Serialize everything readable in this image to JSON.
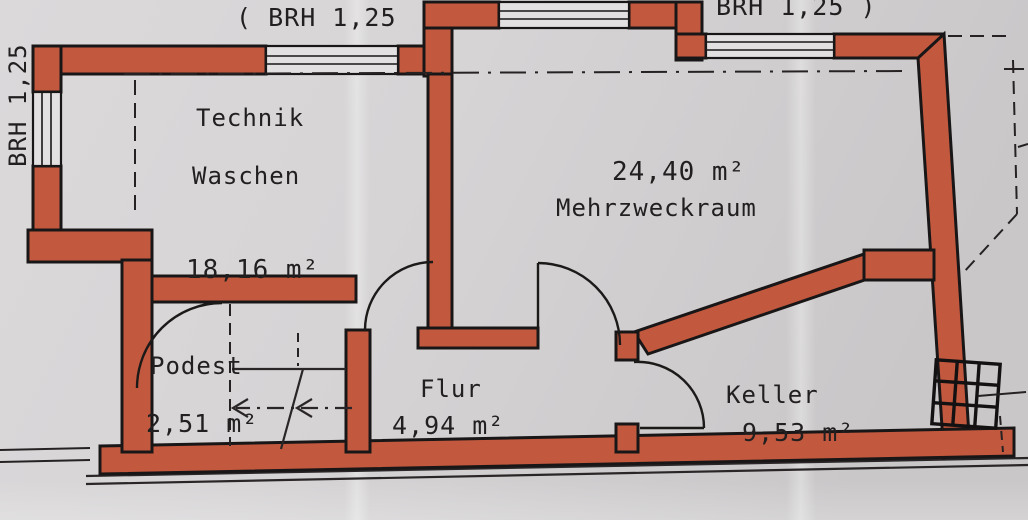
{
  "colors": {
    "paper": "#d5d3d4",
    "wall": "#c2593e",
    "ink": "#221f20",
    "window": "#e2e0e1"
  },
  "annotations": {
    "brh_top_left": "( BRH 1,25",
    "brh_top_right": "BRH 1,25 )",
    "brh_left": "BRH 1,25"
  },
  "rooms": {
    "technik": {
      "name_line1": "Technik",
      "name_line2": "Waschen",
      "area": "18,16 m²"
    },
    "mehrzweckraum": {
      "name": "Mehrzweckraum",
      "area": "24,40 m²"
    },
    "podest": {
      "name": "Podest",
      "area": "2,51 m²"
    },
    "flur": {
      "name": "Flur",
      "area": "4,94 m²"
    },
    "keller": {
      "name": "Keller",
      "area": "9,53 m²"
    }
  }
}
